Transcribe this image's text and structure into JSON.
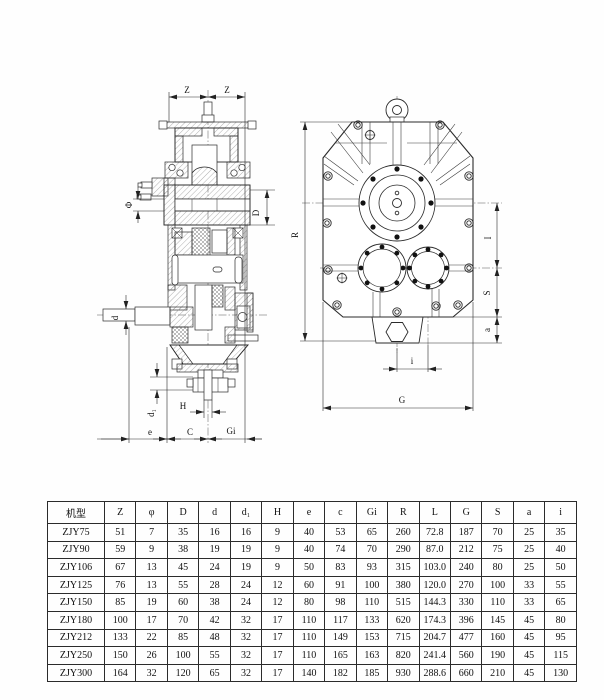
{
  "page": {
    "background": "#fefefe",
    "ink": "#2b2b2b"
  },
  "left_view": {
    "title": "side sectional view",
    "labels": {
      "z_left": "Z",
      "z_right": "Z",
      "phi": "Φ",
      "big_d": "D",
      "small_d": "d",
      "d1": "d₁",
      "h": "H",
      "e": "e",
      "c": "C",
      "g1": "Gi"
    }
  },
  "right_view": {
    "title": "front view",
    "labels": {
      "r": "R",
      "i_upper": "I",
      "s": "S",
      "a": "a",
      "i_lower": "i",
      "g": "G"
    }
  },
  "table": {
    "headers": [
      "机型",
      "Z",
      "φ",
      "D",
      "d",
      "d₁",
      "H",
      "e",
      "c",
      "Gi",
      "R",
      "L",
      "G",
      "S",
      "a",
      "i"
    ],
    "rows": [
      [
        "ZJY75",
        "51",
        "7",
        "35",
        "16",
        "16",
        "9",
        "40",
        "53",
        "65",
        "260",
        "72.8",
        "187",
        "70",
        "25",
        "35"
      ],
      [
        "ZJY90",
        "59",
        "9",
        "38",
        "19",
        "19",
        "9",
        "40",
        "74",
        "70",
        "290",
        "87.0",
        "212",
        "75",
        "25",
        "40"
      ],
      [
        "ZJY106",
        "67",
        "13",
        "45",
        "24",
        "19",
        "9",
        "50",
        "83",
        "93",
        "315",
        "103.0",
        "240",
        "80",
        "25",
        "50"
      ],
      [
        "ZJY125",
        "76",
        "13",
        "55",
        "28",
        "24",
        "12",
        "60",
        "91",
        "100",
        "380",
        "120.0",
        "270",
        "100",
        "33",
        "55"
      ],
      [
        "ZJY150",
        "85",
        "19",
        "60",
        "38",
        "24",
        "12",
        "80",
        "98",
        "110",
        "515",
        "144.3",
        "330",
        "110",
        "33",
        "65"
      ],
      [
        "ZJY180",
        "100",
        "17",
        "70",
        "42",
        "32",
        "17",
        "110",
        "117",
        "133",
        "620",
        "174.3",
        "396",
        "145",
        "45",
        "80"
      ],
      [
        "ZJY212",
        "133",
        "22",
        "85",
        "48",
        "32",
        "17",
        "110",
        "149",
        "153",
        "715",
        "204.7",
        "477",
        "160",
        "45",
        "95"
      ],
      [
        "ZJY250",
        "150",
        "26",
        "100",
        "55",
        "32",
        "17",
        "110",
        "165",
        "163",
        "820",
        "241.4",
        "560",
        "190",
        "45",
        "115"
      ],
      [
        "ZJY300",
        "164",
        "32",
        "120",
        "65",
        "32",
        "17",
        "140",
        "182",
        "185",
        "930",
        "288.6",
        "660",
        "210",
        "45",
        "130"
      ]
    ]
  }
}
